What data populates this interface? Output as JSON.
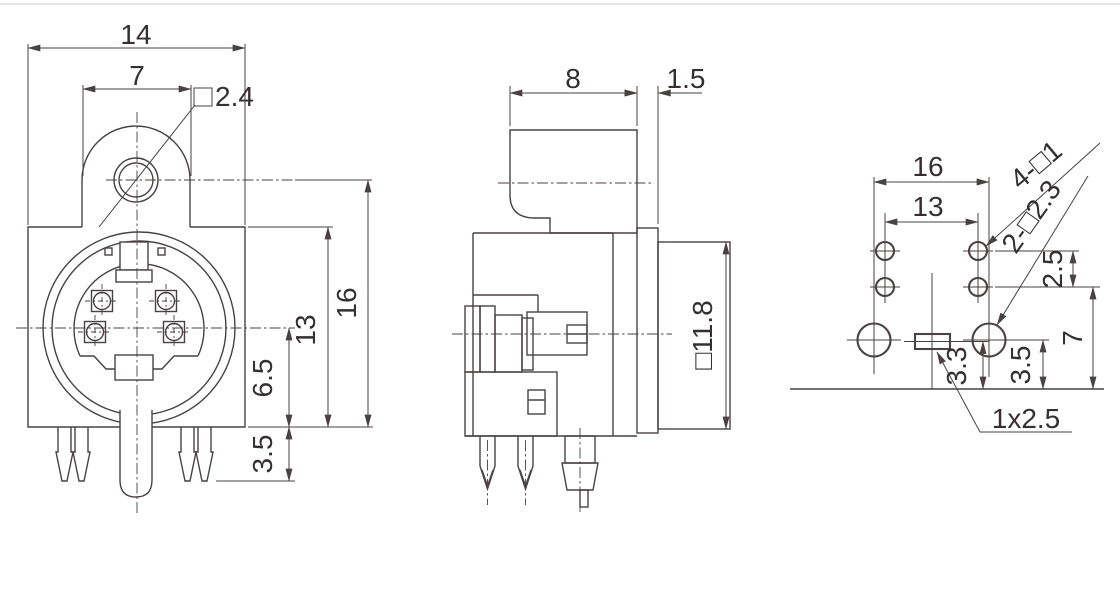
{
  "drawing": {
    "type": "technical-drawing-3-views-mini-din-connector",
    "line_color": "#4a4142",
    "text_color": "#362f30",
    "views": {
      "front": {
        "label": "front-view",
        "dims": {
          "overall_width": "14",
          "ear_width": "7",
          "ear_hole": "□2.4",
          "overall_height": "16",
          "body_height": "13",
          "center_to_bottom": "6.5",
          "peg_length": "3.5"
        }
      },
      "side": {
        "label": "side-view",
        "dims": {
          "ear_depth": "8",
          "flange_thickness": "1.5",
          "shield_size": "□11.8"
        }
      },
      "footprint": {
        "label": "pcb-footprint-view",
        "dims": {
          "mount_pitch": "16",
          "pin_pitch": "13",
          "pin_holes": "4-□1",
          "mount_holes": "2-□2.3",
          "row_pitch": "2.5",
          "depth": "7",
          "slot_offset": "3.3",
          "mount_offset": "3.5",
          "slot_size": "1x2.5"
        }
      }
    }
  }
}
